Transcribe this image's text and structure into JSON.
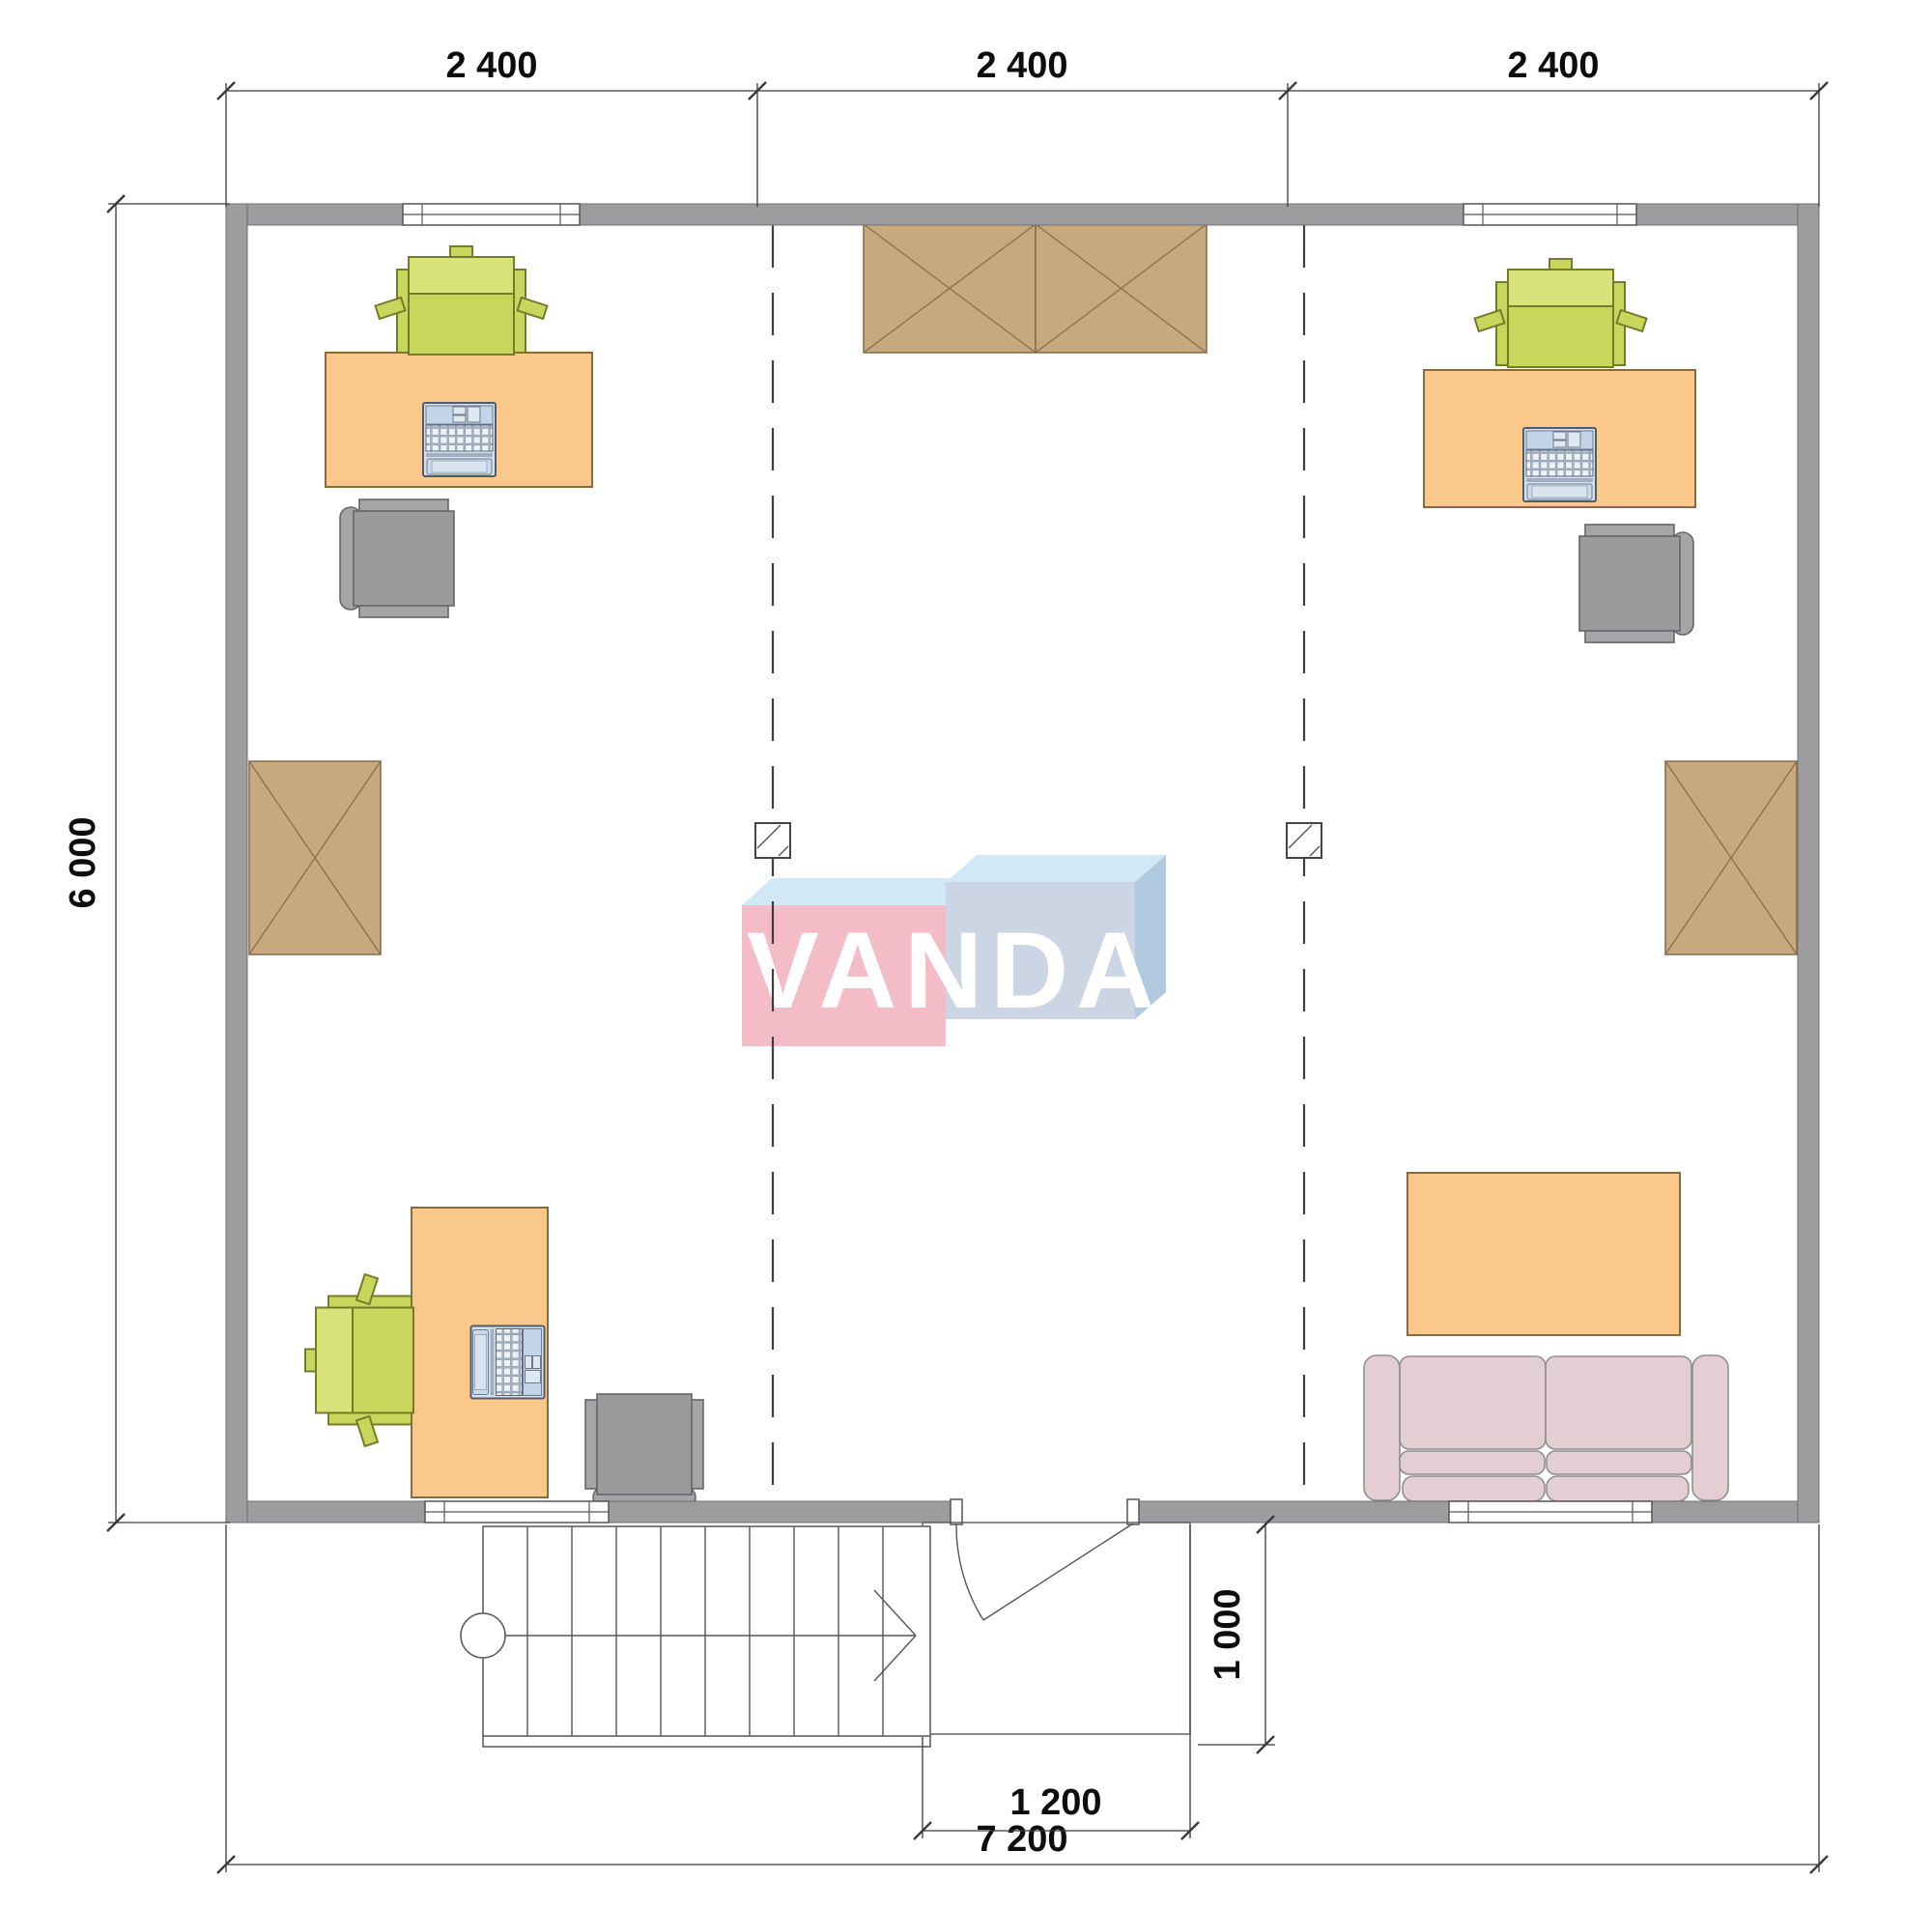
{
  "drawing": {
    "type": "architectural floor plan, second storey office layout",
    "watermark": {
      "text": "VANDA"
    },
    "dimensions": {
      "top": [
        "2 400",
        "2 400",
        "2 400"
      ],
      "left_height": "6 000",
      "bottom_total": "7 200",
      "entry_width": "1 200",
      "entry_depth": "1 000"
    }
  },
  "colors": {
    "wall": "#9d9da0",
    "desk": "#fbc88c",
    "chair_green": "#c9d65c",
    "chair_gray": "#9b9b9b",
    "cabinet": "#c8a87d",
    "sofa": "#e3ced3",
    "dim": "#3a3a3a",
    "logo_pink": "#f4b9c3",
    "logo_blue_light": "#cfe7f6",
    "logo_blue_gray": "#c9d3e3"
  }
}
